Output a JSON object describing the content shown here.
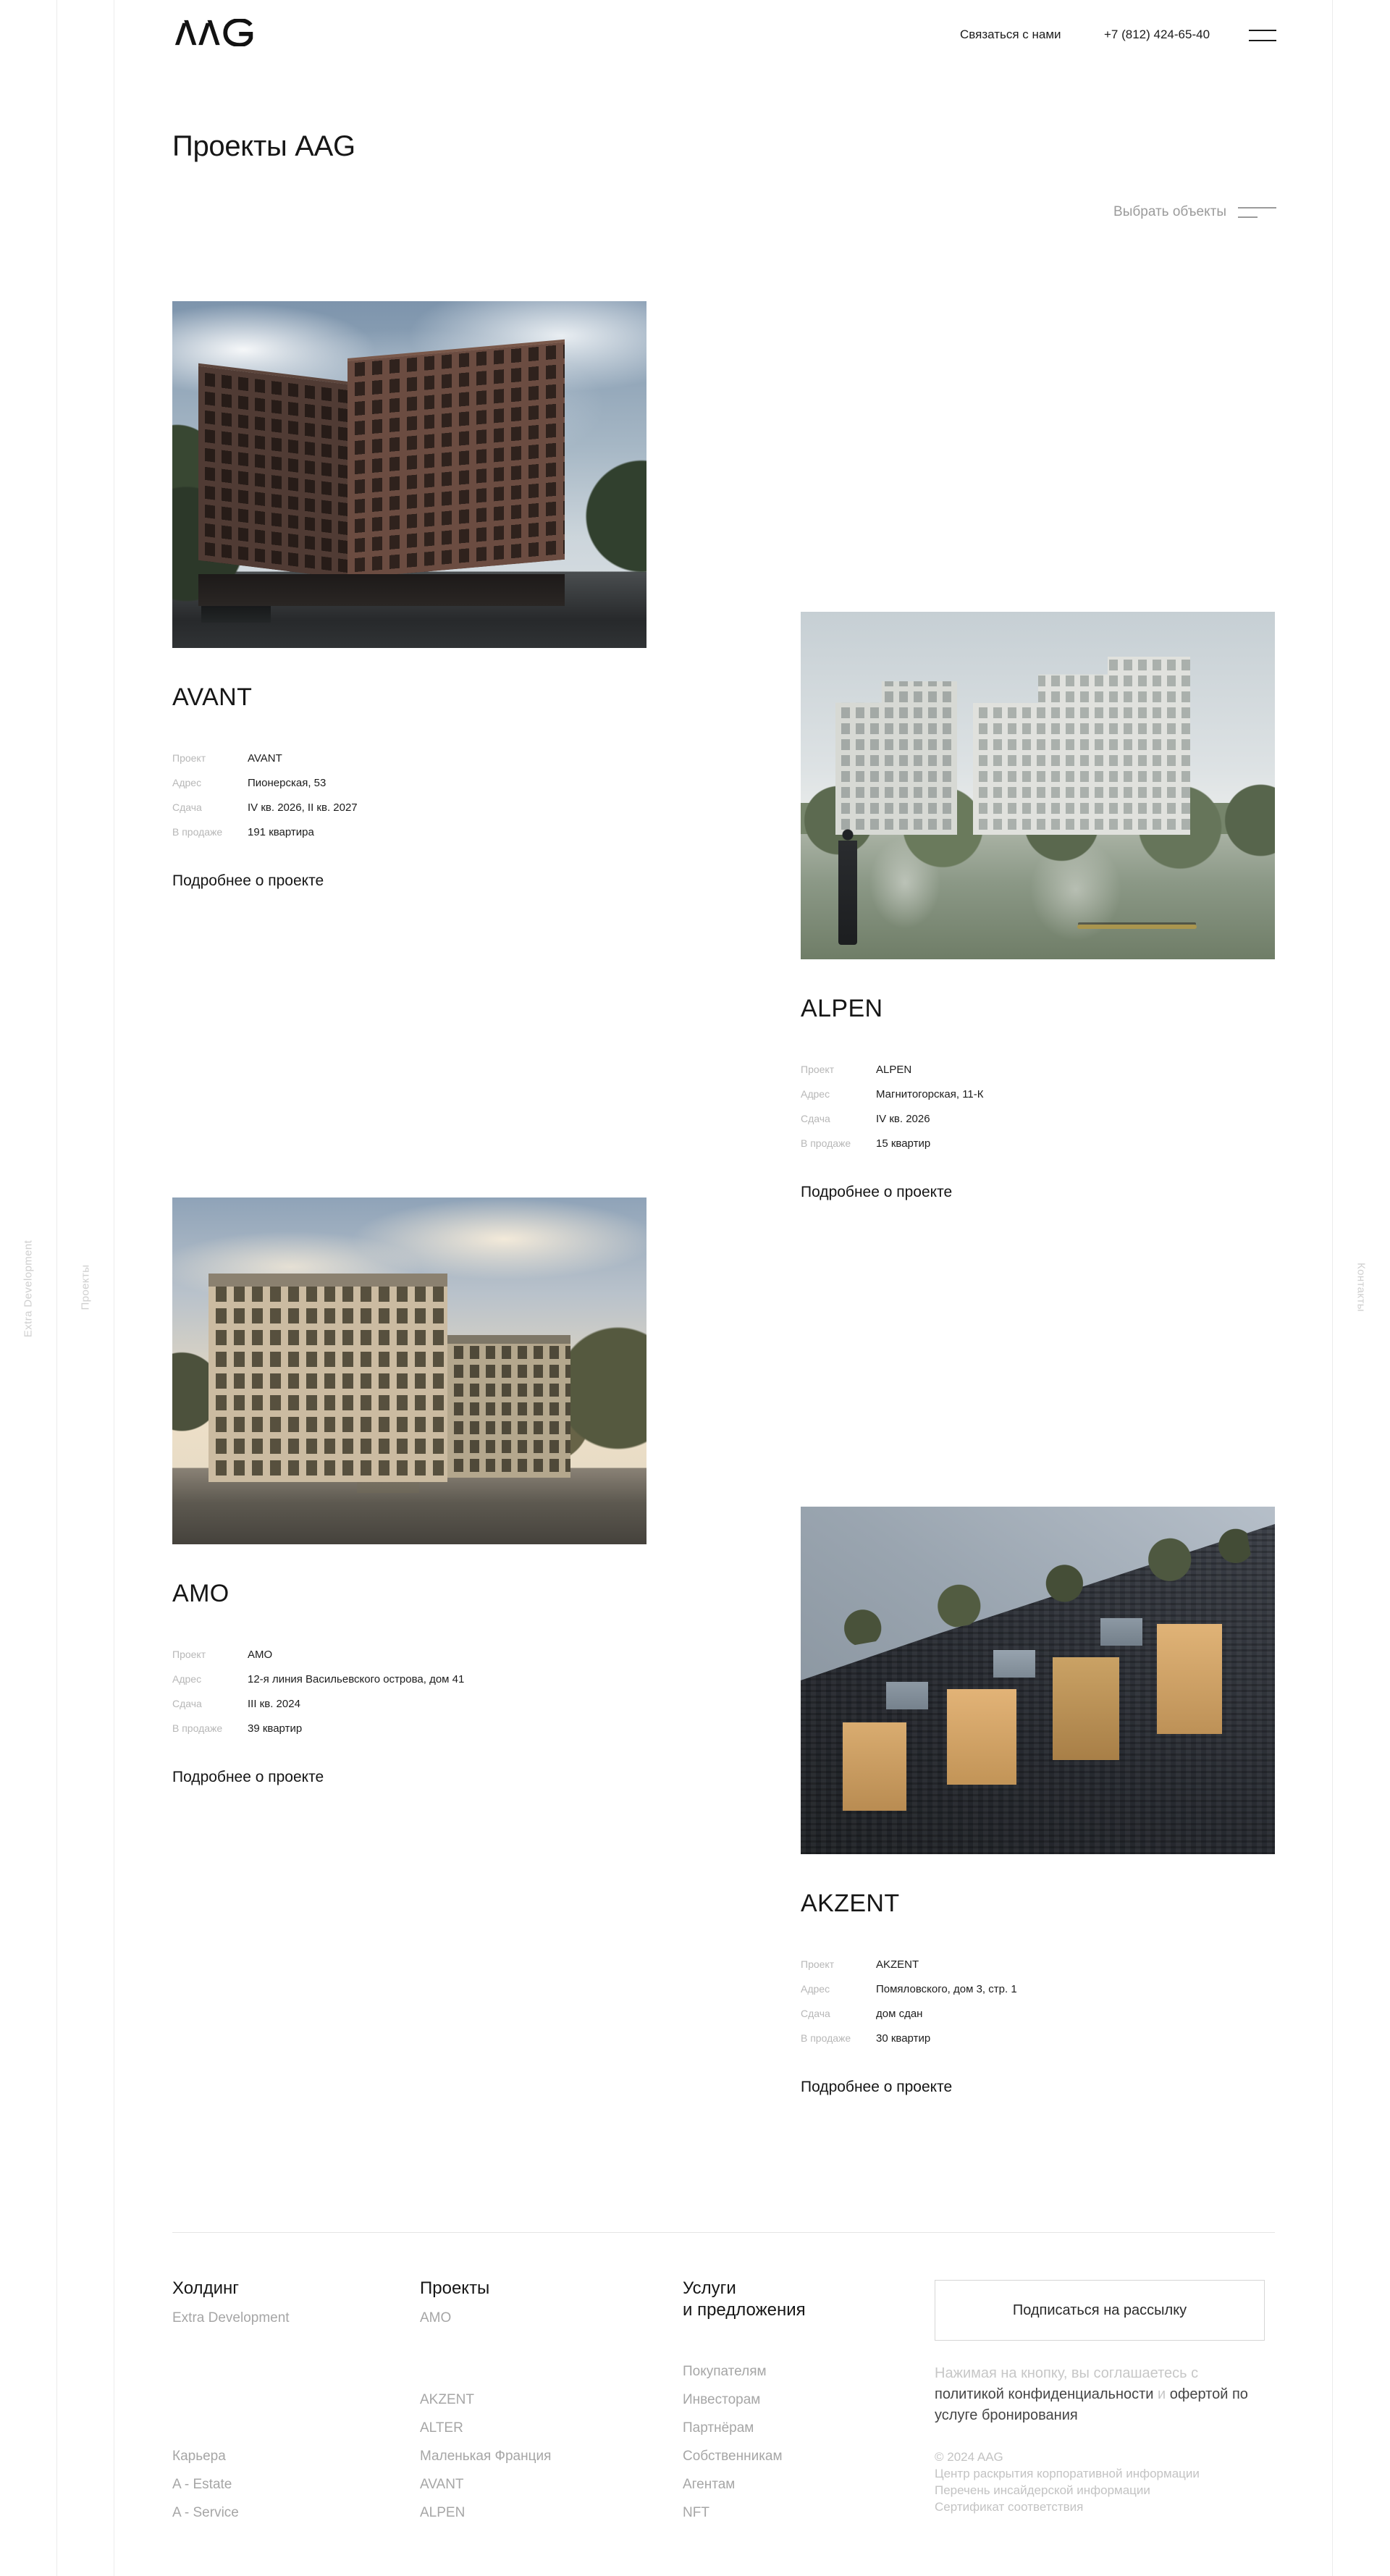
{
  "header": {
    "logo": "AAG",
    "contact_label": "Связаться с нами",
    "phone": "+7 (812) 424-65-40"
  },
  "page": {
    "title": "Проекты AAG",
    "filter_label": "Выбрать объекты"
  },
  "side_rails": {
    "left_outer": "Extra Development",
    "left_inner": "Проекты",
    "right": "Контакты"
  },
  "labels": {
    "project": "Проект",
    "address": "Адрес",
    "completion": "Сдача",
    "on_sale": "В продаже",
    "details_link": "Подробнее о проекте"
  },
  "projects": [
    {
      "name": "AVANT",
      "project": "AVANT",
      "address": "Пионерская, 53",
      "completion": "IV кв. 2026, II кв. 2027",
      "on_sale": "191 квартира"
    },
    {
      "name": "ALPEN",
      "project": "ALPEN",
      "address": "Магнитогорская, 11-К",
      "completion": "IV кв. 2026",
      "on_sale": "15 квартир"
    },
    {
      "name": "AMO",
      "project": "AMO",
      "address": "12-я линия Васильевского острова, дом 41",
      "completion": "III кв. 2024",
      "on_sale": "39 квартир"
    },
    {
      "name": "AKZENT",
      "project": "AKZENT",
      "address": "Помяловского, дом 3, стр. 1",
      "completion": "дом сдан",
      "on_sale": "30 квартир"
    }
  ],
  "footer": {
    "col_holding": {
      "title": "Холдинг",
      "brand": "Extra Development",
      "links": [
        "Карьера",
        "A - Estate",
        "A - Service"
      ]
    },
    "col_projects": {
      "title": "Проекты",
      "top": [
        "AMO"
      ],
      "links": [
        "AKZENT",
        "ALTER",
        "Маленькая Франция",
        "AVANT",
        "ALPEN"
      ]
    },
    "col_services": {
      "title": "Услуги\nи предложения",
      "links": [
        "Покупателям",
        "Инвесторам",
        "Партнёрам",
        "Собственникам",
        "Агентам",
        "NFT"
      ]
    },
    "subscribe_button": "Подписаться на рассылку",
    "legal_prefix": "Нажимая на кнопку, вы соглашаетесь с",
    "legal_link_privacy": "политикой конфиденциальности",
    "legal_and": "и",
    "legal_link_offer": "офертой по услуге бронирования",
    "copyright": "© 2024 AAG",
    "legal_links": [
      "Центр раскрытия корпоративной информации",
      "Перечень инсайдерской информации",
      "Сертификат соответствия"
    ]
  }
}
